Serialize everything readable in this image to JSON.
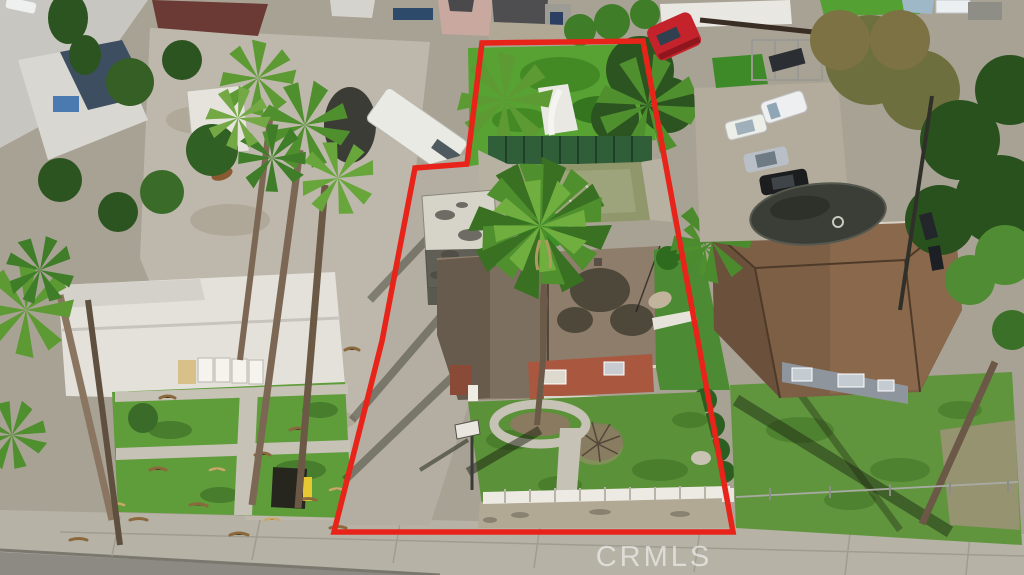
{
  "watermark": {
    "text": "CRMLS",
    "color": "rgba(255,255,255,0.55)"
  },
  "boundary": {
    "color": "#e8231a",
    "stroke_width": 5.5,
    "points": "482,43 467,164 415,168 382,341 334,532 733,532 643,41"
  },
  "palette": {
    "asphalt": "#8d8a83",
    "sidewalk": "#b6b2a6",
    "concrete": "#bdb8ab",
    "concrete_dark": "#a29c8f",
    "grass_bright": "#5f9c3a",
    "grass_dark": "#3f7028",
    "grass_overgrown": "#57a232",
    "tree_dark": "#2c5420",
    "tree_olive": "#6e6f3e",
    "palm_green": "#4f8f2e",
    "subject_roof": "#8d7d6a",
    "subject_roof_shadow": "#564b40",
    "subject_wall_salmon": "#a9573f",
    "right_house_roof": "#7d5f46",
    "left_house_roof": "#e3e1da",
    "sport_court": "#8f976b",
    "court_fence_green": "#2f5e39",
    "red_truck": "#c4232b",
    "white_vehicle": "#edeff1",
    "silver_car": "#b9bfc6",
    "black_car": "#1b1d1f",
    "pool_cover_dark": "#3a3e36",
    "picket_fence_white": "#eceae2"
  },
  "scene": {
    "type": "aerial-drone-photo-of-residential-property",
    "subject_property": {
      "features": [
        "red-boundary-outline",
        "front-lawn",
        "white-picket-fence",
        "central-palm-tree",
        "tan-roof-house",
        "salmon-stucco-walls",
        "concrete-driveway",
        "portable-basketball-hoop",
        "sport-court-with-circle-marking",
        "green-court-fence",
        "detached-garage-weathered-roof",
        "overgrown-back-lawn",
        "back-palm-trees",
        "dead-bush",
        "circular-planter-walkway",
        "gravel-parkway-strip"
      ]
    },
    "left_neighbor": {
      "features": [
        "white-roof-house",
        "carport-with-white-panels",
        "lawn-with-palm-debris",
        "tall-palm-trees",
        "large-concrete-driveway",
        "white-box-truck-rv",
        "blue-gray-roof-house",
        "maroon-roof-house",
        "black-bin",
        "yellow-object"
      ]
    },
    "right_neighbor": {
      "features": [
        "brown-shingle-roof-house",
        "gray-walls-with-windows",
        "front-lawn",
        "rear-driveway-with-cars",
        "white-minivan",
        "white-sedan",
        "silver-sedan",
        "black-sedan",
        "dark-covered-pool",
        "putting-green",
        "metal-carport-frame",
        "dense-trees",
        "leaning-palm-trunk",
        "chain-link-fence"
      ]
    },
    "street": {
      "features": [
        "sidewalk",
        "asphalt-road",
        "curb-gutter"
      ]
    },
    "top_row": {
      "features": [
        "red-semi-truck-cab",
        "long-white-building",
        "pink-two-story-house",
        "dark-roof-houses",
        "gray-shed",
        "blue-tarps",
        "white-rv-top-right"
      ]
    }
  }
}
